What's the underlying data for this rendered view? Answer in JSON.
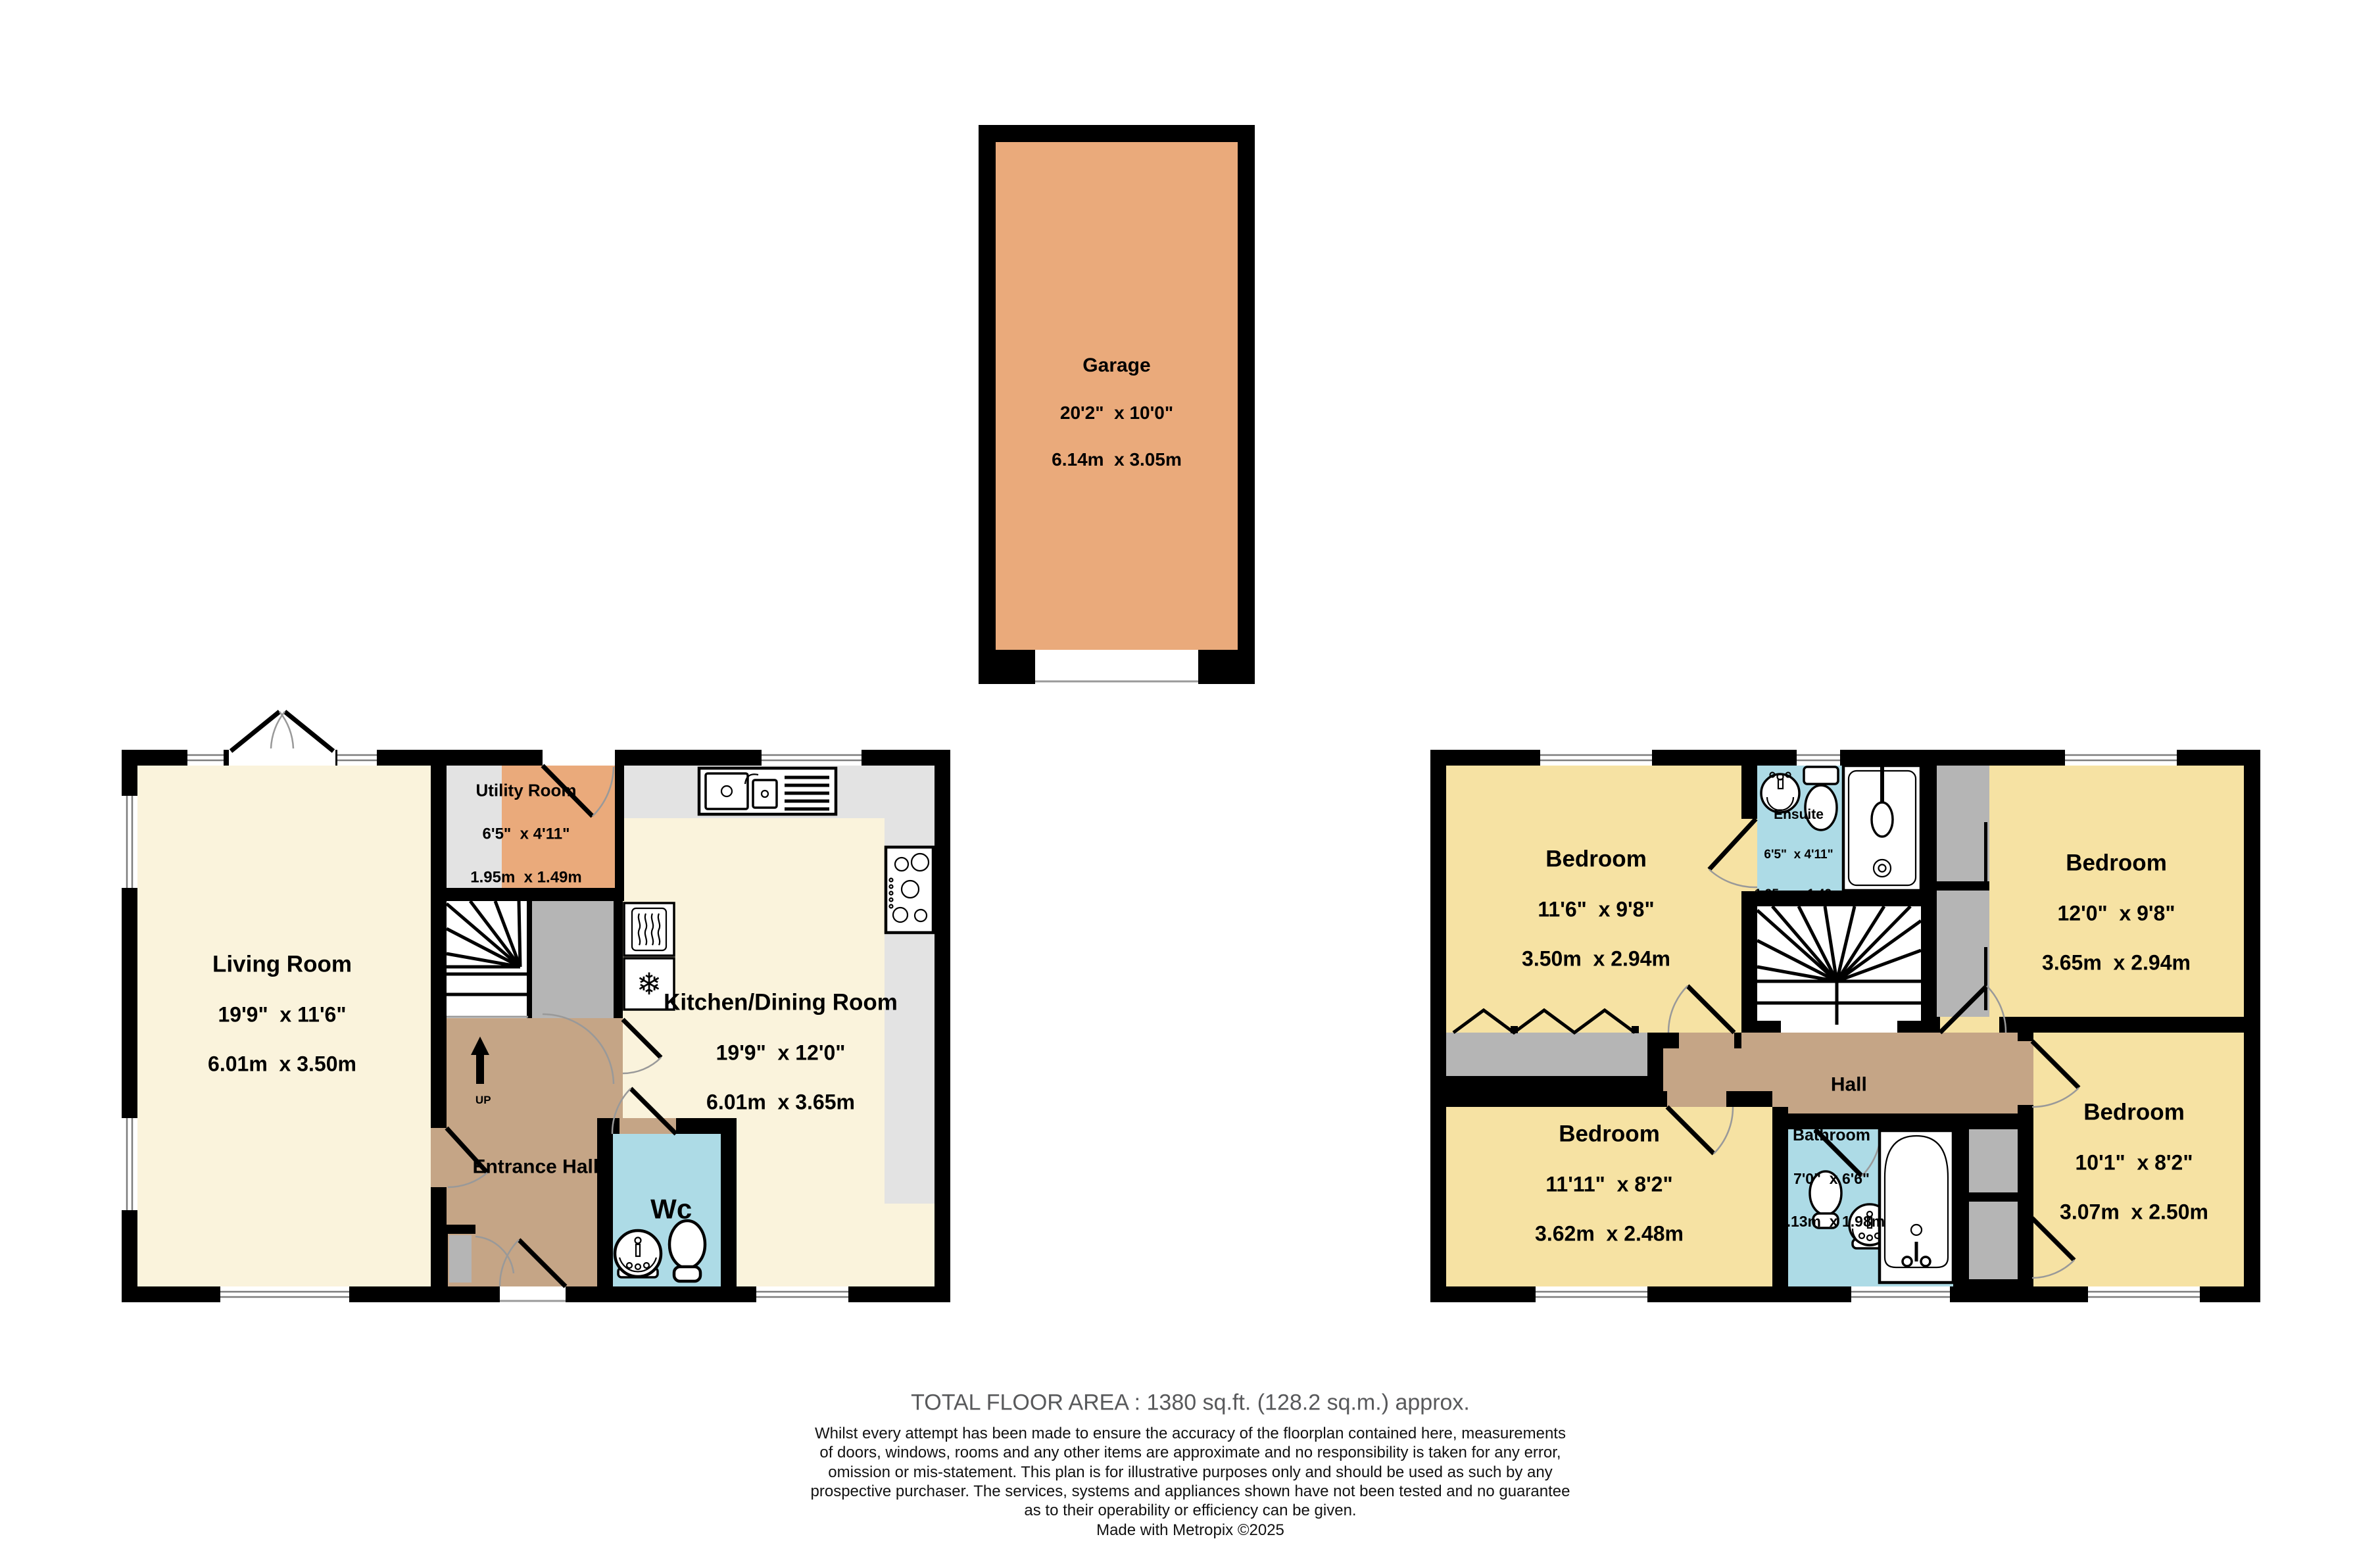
{
  "garage": {
    "name": "Garage",
    "imperial": "20'2\"  x 10'0\"",
    "metric": "6.14m  x 3.05m"
  },
  "ground_floor": {
    "living_room": {
      "name": "Living Room",
      "imperial": "19'9\"  x 11'6\"",
      "metric": "6.01m  x 3.50m"
    },
    "utility_room": {
      "name": "Utility Room",
      "imperial": "6'5\"  x 4'11\"",
      "metric": "1.95m  x 1.49m"
    },
    "kitchen_dining_room": {
      "name": "Kitchen/Dining Room",
      "imperial": "19'9\"  x 12'0\"",
      "metric": "6.01m  x 3.65m"
    },
    "entrance_hall": {
      "name": "Entrance Hall"
    },
    "wc": {
      "name": "Wc"
    },
    "stairs": {
      "direction_label": "UP"
    }
  },
  "first_floor": {
    "bedroom_top_left": {
      "name": "Bedroom",
      "imperial": "11'6\"  x 9'8\"",
      "metric": "3.50m  x 2.94m"
    },
    "ensuite": {
      "name": "Ensuite",
      "imperial": "6'5\"  x 4'11\"",
      "metric": "1.95m  x 1.49m"
    },
    "bedroom_top_right": {
      "name": "Bedroom",
      "imperial": "12'0\"  x 9'8\"",
      "metric": "3.65m  x 2.94m"
    },
    "hall": {
      "name": "Hall"
    },
    "bedroom_bottom_left": {
      "name": "Bedroom",
      "imperial": "11'11\"  x 8'2\"",
      "metric": "3.62m  x 2.48m"
    },
    "bathroom": {
      "name": "Bathroom",
      "imperial": "7'0\"  x 6'6\"",
      "metric": "2.13m  x 1.98m"
    },
    "bedroom_bottom_right": {
      "name": "Bedroom",
      "imperial": "10'1\"  x 8'2\"",
      "metric": "3.07m  x 2.50m"
    }
  },
  "footer": {
    "total_area": "TOTAL FLOOR AREA : 1380 sq.ft. (128.2 sq.m.) approx.",
    "disclaimer": "Whilst every attempt has been made to ensure the accuracy of the floorplan contained here, measurements\nof doors, windows, rooms and any other items are approximate and no responsibility is taken for any error,\nomission or mis-statement. This plan is for illustrative purposes only and should be used as such by any\nprospective purchaser. The services, systems and appliances shown have not been tested and no guarantee\nas to their operability or efficiency can be given.",
    "credit": "Made with Metropix ©2025"
  },
  "icons": {
    "freezer_snowflake": "❄"
  },
  "colors": {
    "wall": "#000000",
    "cream": "#faf3dc",
    "yellow": "#f6e2a3",
    "orange": "#eaaa7b",
    "brown": "#c5a586",
    "blue": "#addbe6",
    "gray_cupboard": "#b5b5b5",
    "gray_counter": "#e3e3e3"
  }
}
